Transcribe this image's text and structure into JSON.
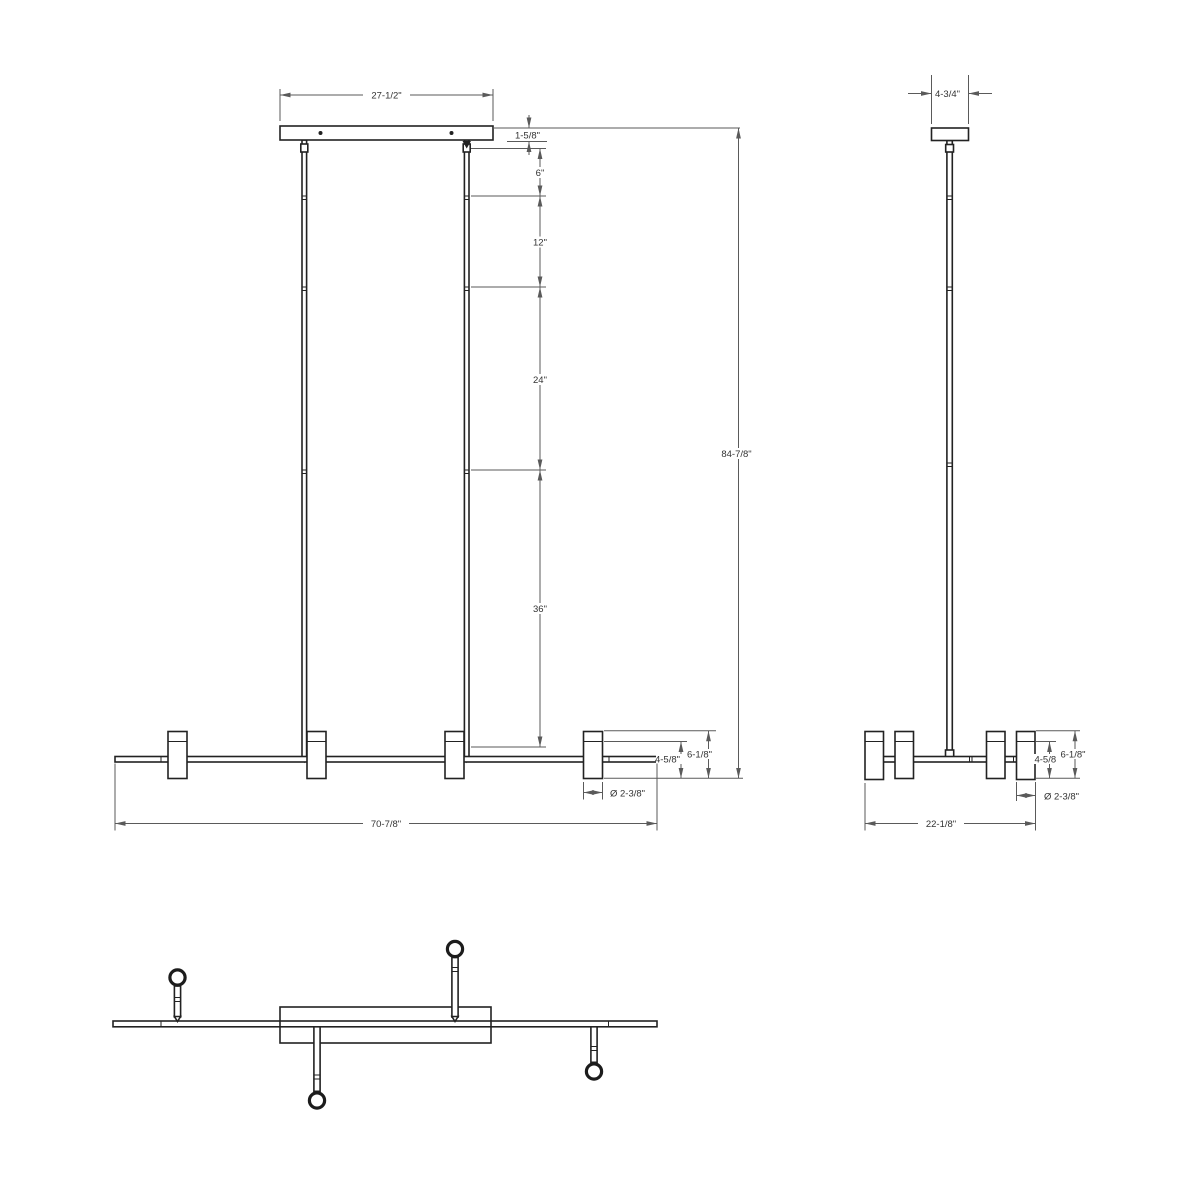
{
  "colors": {
    "object_line": "#222222",
    "dimension_line": "#5a5a5a",
    "text": "#333333",
    "background": "#ffffff"
  },
  "views": {
    "front": {
      "dims": {
        "canopy_width": "27-1/2\"",
        "canopy_thickness": "1-5/8\"",
        "stem_segment_1": "6\"",
        "stem_segment_2": "12\"",
        "stem_segment_3": "24\"",
        "stem_segment_4": "36\"",
        "overall_height": "84-7/8\"",
        "head_body_height": "4-5/8\"",
        "head_overall_height": "6-1/8\"",
        "head_diameter": "Ø 2-3/8\"",
        "overall_width": "70-7/8\""
      }
    },
    "side": {
      "dims": {
        "canopy_width": "4-3/4\"",
        "head_body_height": "4-5/8\"",
        "head_overall_height": "6-1/8\"",
        "head_diameter": "Ø 2-3/8\"",
        "overall_width": "22-1/8\""
      }
    }
  }
}
